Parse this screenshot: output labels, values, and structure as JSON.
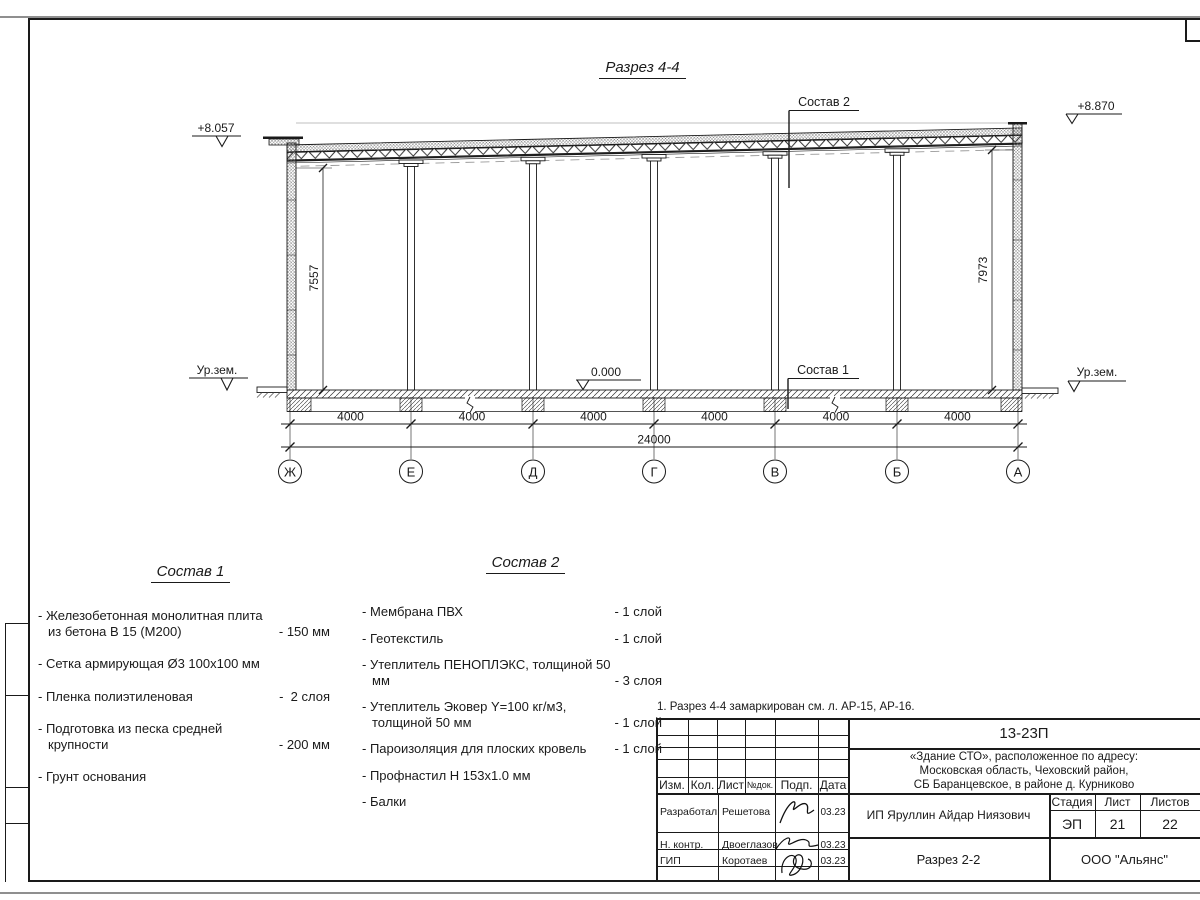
{
  "sheet": {
    "title": "Разрез 4-4",
    "note": "1. Разрез 4-4 замаркирован см. л. АР-15, АР-16.",
    "colors": {
      "ink": "#1a1a1a",
      "paper": "#ffffff"
    }
  },
  "section": {
    "elev_roof_left": "+8.057",
    "elev_roof_right": "+8.870",
    "elev_floor": "0.000",
    "ground_left": "Ур.зем.",
    "ground_right": "Ур.зем.",
    "leader_top": "Состав 2",
    "leader_bottom": "Состав 1",
    "dim_left": "7557",
    "dim_right": "7973",
    "bays": [
      "4000",
      "4000",
      "4000",
      "4000",
      "4000",
      "4000"
    ],
    "total": "24000",
    "axes": [
      "Ж",
      "Е",
      "Д",
      "Г",
      "В",
      "Б",
      "А"
    ]
  },
  "sostav1": {
    "title": "Состав 1",
    "items": [
      {
        "name": "- Железобетонная  монолитная плита из бетона В 15 (М200)",
        "value": "- 150 мм"
      },
      {
        "name": "- Сетка армирующая Ø3 100х100 мм",
        "value": ""
      },
      {
        "name": "- Пленка полиэтиленовая",
        "value": "-  2 слоя"
      },
      {
        "name": "- Подготовка из песка средней крупности",
        "value": "- 200 мм"
      },
      {
        "name": "- Грунт основания",
        "value": ""
      }
    ]
  },
  "sostav2": {
    "title": "Состав 2",
    "items": [
      {
        "name": "- Мембрана ПВХ",
        "value": "- 1 слой"
      },
      {
        "name": "- Геотекстиль",
        "value": "- 1 слой"
      },
      {
        "name": "- Утеплитель ПЕНОПЛЭКС, толщиной 50 мм",
        "value": "- 3 слоя"
      },
      {
        "name": "- Утеплитель Эковер Y=100 кг/м3, толщиной 50 мм",
        "value": "- 1 слой"
      },
      {
        "name": "- Пароизоляция для плоских кровель",
        "value": "- 1 слой"
      },
      {
        "name": "- Профнастил Н 153х1.0 мм",
        "value": ""
      },
      {
        "name": "- Балки",
        "value": ""
      }
    ]
  },
  "titleblock": {
    "doc_number": "13-23П",
    "project_line1": "«Здание СТО», расположенное по адресу:",
    "project_line2": "Московская область, Чеховский район,",
    "project_line3": "СБ Баранцевское, в районе д. Курниково",
    "col_izm": "Изм.",
    "col_kol": "Кол.",
    "col_list": "Лист",
    "col_ndok": "№док.",
    "col_podp": "Подп.",
    "col_data": "Дата",
    "rows": [
      {
        "role": "Разработал",
        "name": "Решетова",
        "date": "03.23"
      },
      {
        "role": "Н. контр.",
        "name": "Двоеглазов",
        "date": "03.23"
      },
      {
        "role": "ГИП",
        "name": "Коротаев",
        "date": "03.23"
      }
    ],
    "client": "ИП Яруллин Айдар Ниязович",
    "stage_label": "Стадия",
    "list_label": "Лист",
    "listov_label": "Листов",
    "stage": "ЭП",
    "list_no": "21",
    "listov_no": "22",
    "drawing_name": "Разрез 2-2",
    "company": "ООО \"Альянс\""
  }
}
